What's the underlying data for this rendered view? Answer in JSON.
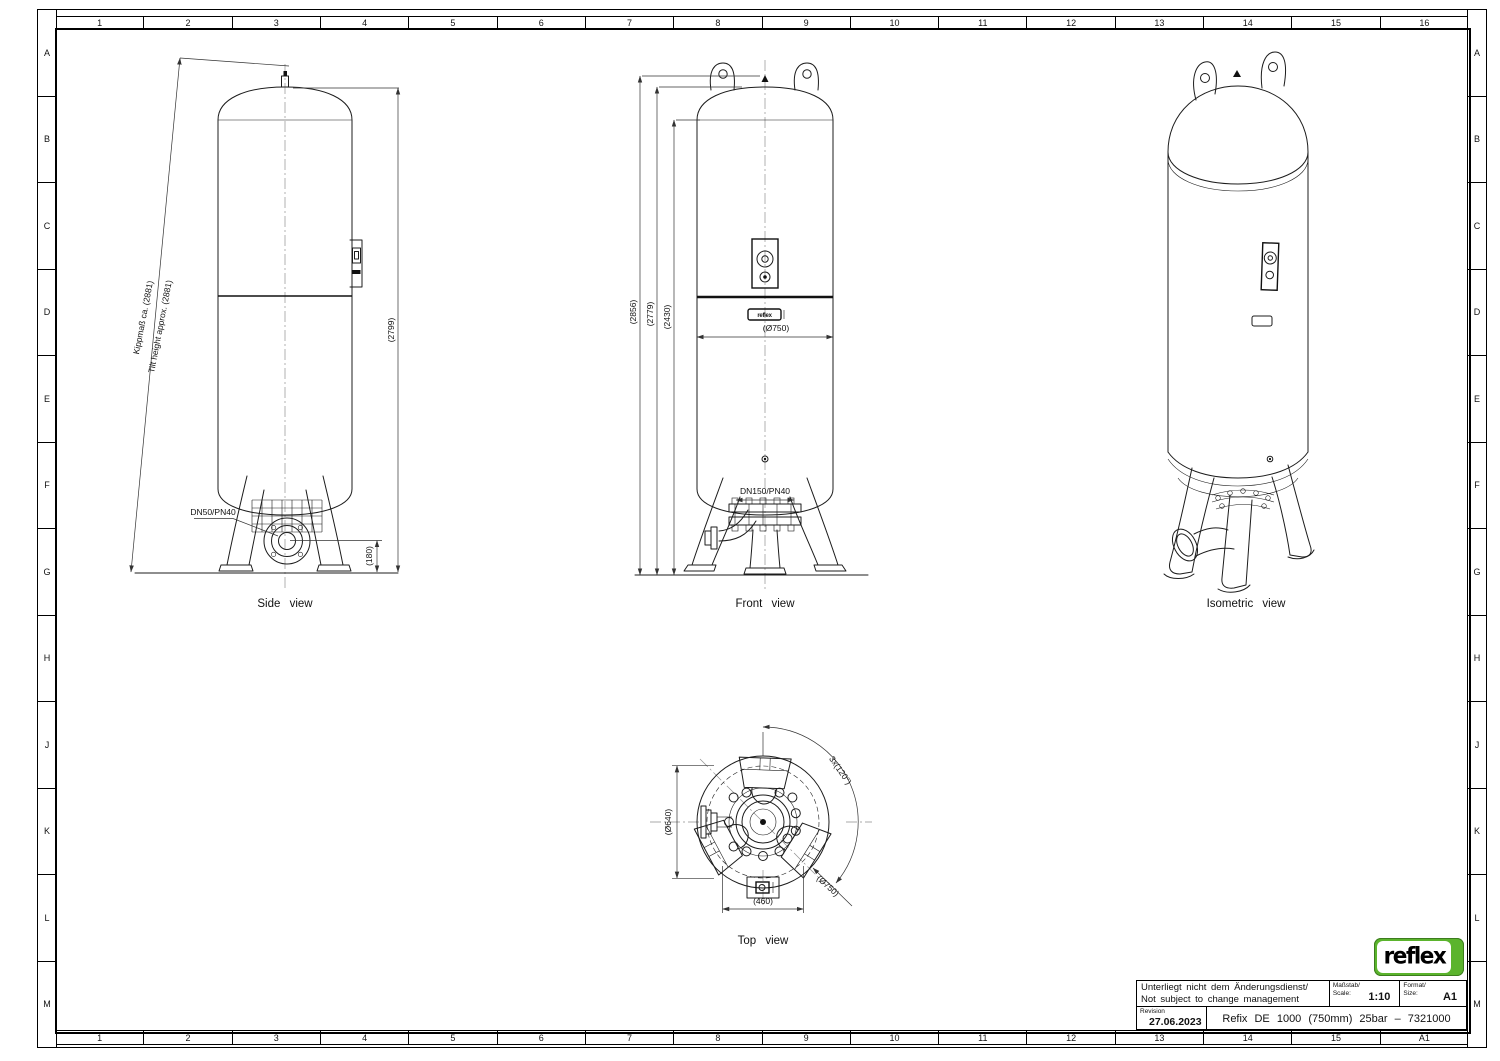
{
  "border": {
    "columns": [
      "1",
      "2",
      "3",
      "4",
      "5",
      "6",
      "7",
      "8",
      "9",
      "10",
      "11",
      "12",
      "13",
      "14",
      "15",
      "16"
    ],
    "rows": [
      "A",
      "B",
      "C",
      "D",
      "E",
      "F",
      "G",
      "H",
      "J",
      "K",
      "L",
      "M"
    ],
    "corner_code": "A1"
  },
  "views": {
    "side": {
      "label": "Side view",
      "dims": {
        "tilt_de": "Kippmaß ca. (2881)",
        "tilt_en": "Tilt height approx. (2881)",
        "height": "(2799)",
        "base": "(180)",
        "nozzle": "DN50/PN40"
      }
    },
    "front": {
      "label": "Front view",
      "nameplate": "reflex",
      "dims": {
        "h1": "(2856)",
        "h2": "(2779)",
        "h3": "(2430)",
        "diameter": "(Ø750)",
        "nozzle": "DN150/PN40"
      }
    },
    "iso": {
      "label": "Isometric view"
    },
    "top": {
      "label": "Top view",
      "dims": {
        "bolt_circle": "(Ø640)",
        "outer": "(Ø750)",
        "spacing": "(460)",
        "angle": "3x(120°)"
      }
    }
  },
  "title_block": {
    "change_note_de": "Unterliegt nicht dem Änderungsdienst/",
    "change_note_en": "Not subject to change management",
    "scale_label_de": "Maßstab/",
    "scale_label_en": "Scale:",
    "scale_value": "1:10",
    "format_label_de": "Format/",
    "format_label_en": "Size:",
    "format_value": "A1",
    "revision_label": "Revision",
    "revision_date": "27.06.2023",
    "drawing_title": "Refix DE 1000 (750mm) 25bar – 7321000"
  },
  "logo": {
    "text": "reflex",
    "green": "#5bb42d"
  }
}
